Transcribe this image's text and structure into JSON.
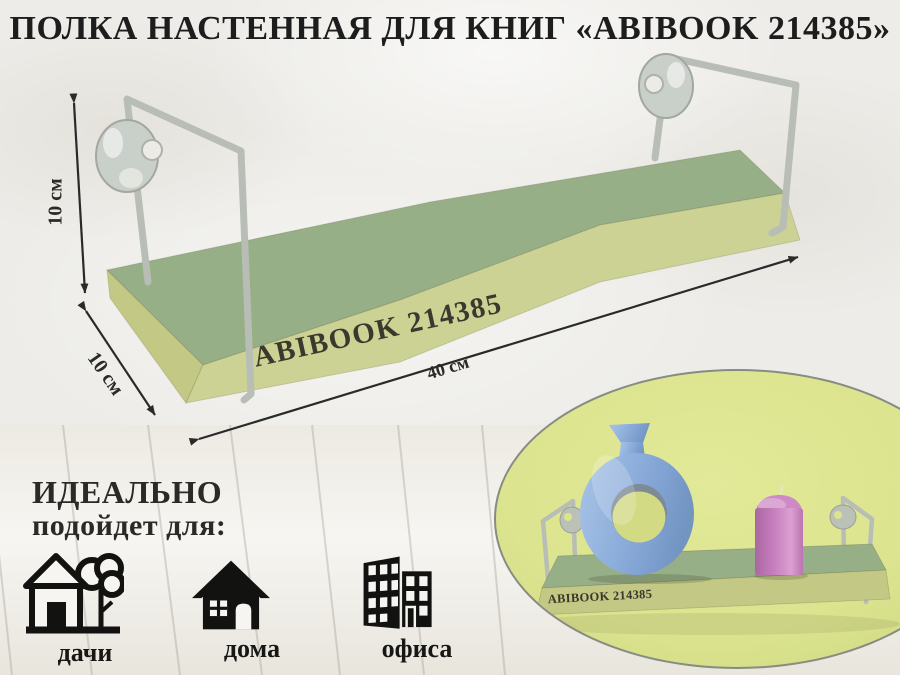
{
  "header": {
    "title": "ПОЛКА НАСТЕННАЯ ДЛЯ КНИГ «ABIBOOK 214385»"
  },
  "product": {
    "label": "ABIBOOK 214385"
  },
  "dimensions": {
    "height": "10 см",
    "depth": "10 см",
    "width": "40 см"
  },
  "ideal": {
    "line1": "ИДЕАЛЬНО",
    "line2": "подойдет для:"
  },
  "uses": {
    "items": [
      {
        "icon": "dacha-house-tree-icon",
        "label": "дачи"
      },
      {
        "icon": "house-icon",
        "label": "дома"
      },
      {
        "icon": "office-building-icon",
        "label": "офиса"
      }
    ]
  },
  "inset": {
    "shelf_label": "ABIBOOK 214385",
    "objects": [
      {
        "name": "blue-donut-vase"
      },
      {
        "name": "pink-pillar-candle"
      }
    ]
  },
  "colors": {
    "wall": "#edece8",
    "wood": "#f1efe9",
    "green": "#97af86",
    "front": "#ccd194",
    "endface": "#c3c885",
    "lime": "#dce48f",
    "rail": "#b8beb5",
    "ink": "#2b2a26",
    "title": "#1d1d1d",
    "blue": "#8fb0dc",
    "pink": "#c57dbd"
  }
}
